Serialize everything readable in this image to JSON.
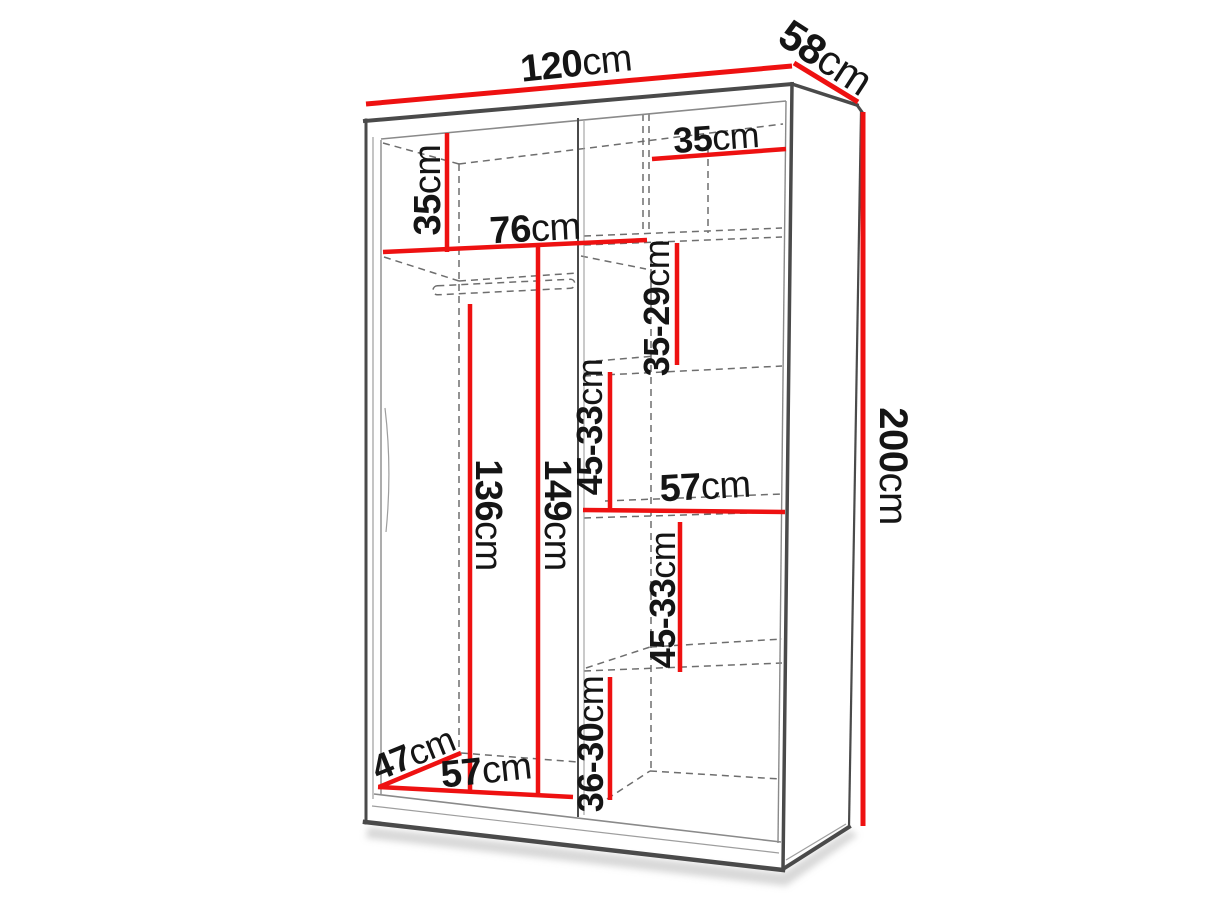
{
  "figure": {
    "kind": "furniture-dimension-diagram",
    "subject": "two-door sliding wardrobe with interior shelf dimensions",
    "palette": {
      "dimension": "#ee1111",
      "edge_dark": "#4a4a4a",
      "edge_mid": "#8a8a8a",
      "hidden": "#6e6e6e",
      "label": "#151515",
      "background": "#ffffff"
    },
    "dimensions": [
      {
        "id": "overall-width",
        "value": "120",
        "unit": "cm"
      },
      {
        "id": "overall-depth",
        "value": "58",
        "unit": "cm"
      },
      {
        "id": "top-shelf-height-left",
        "value": "35",
        "unit": "cm"
      },
      {
        "id": "top-shelf-width-right",
        "value": "35",
        "unit": "cm"
      },
      {
        "id": "left-section-width",
        "value": "76",
        "unit": "cm"
      },
      {
        "id": "upper-shelf-spacing-right",
        "value": "35-29",
        "unit": "cm"
      },
      {
        "id": "mid-upper-shelf-spacing-right",
        "value": "45-33",
        "unit": "cm"
      },
      {
        "id": "hanging-space-height",
        "value": "136",
        "unit": "cm"
      },
      {
        "id": "left-interior-height",
        "value": "149",
        "unit": "cm"
      },
      {
        "id": "right-shelf-width",
        "value": "57",
        "unit": "cm"
      },
      {
        "id": "mid-lower-shelf-spacing-right",
        "value": "45-33",
        "unit": "cm"
      },
      {
        "id": "bottom-shelf-spacing-right",
        "value": "36-30",
        "unit": "cm"
      },
      {
        "id": "overall-height",
        "value": "200",
        "unit": "cm"
      },
      {
        "id": "interior-depth",
        "value": "47",
        "unit": "cm"
      },
      {
        "id": "left-section-bottom-width",
        "value": "57",
        "unit": "cm"
      }
    ]
  }
}
